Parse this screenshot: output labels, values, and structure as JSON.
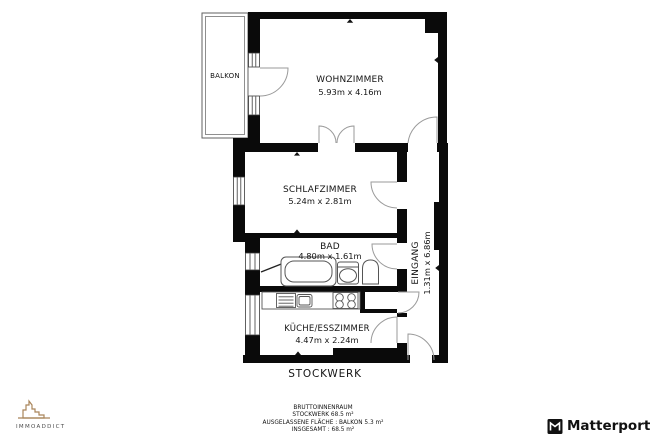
{
  "plan": {
    "balcony": {
      "label": "BALKON"
    },
    "living_room": {
      "label": "WOHNZIMMER",
      "dims": "5.93m x 4.16m"
    },
    "bedroom": {
      "label": "SCHLAFZIMMER",
      "dims": "5.24m x 2.81m"
    },
    "bathroom": {
      "label": "BAD",
      "dims": "4.80m x 1.61m"
    },
    "kitchen": {
      "label": "KÜCHE/ESSZIMMER",
      "dims": "4.47m x 2.24m"
    },
    "entrance": {
      "label": "EINGANG",
      "dims": "1.31m x 6.86m"
    },
    "floor_label": "STOCKWERK"
  },
  "summary": {
    "title": "BRUTTOINNENRAUM",
    "floor_area": "STOCKWERK 68.5 m²",
    "excluded_area": "AUSGELASSENE FLÄCHE :  BALKON 5.3 m²",
    "total_area": "INSGESAMT :  68.5 m²"
  },
  "branding": {
    "left_logo": "IMMOADDICT",
    "right_logo": "Matterport"
  },
  "colors": {
    "wall": "#0a0a0a",
    "door_arc": "#9a9a9a",
    "fixture": "#555555",
    "window_frame": "#3a3a3a",
    "logo_tan": "#a9855a"
  }
}
